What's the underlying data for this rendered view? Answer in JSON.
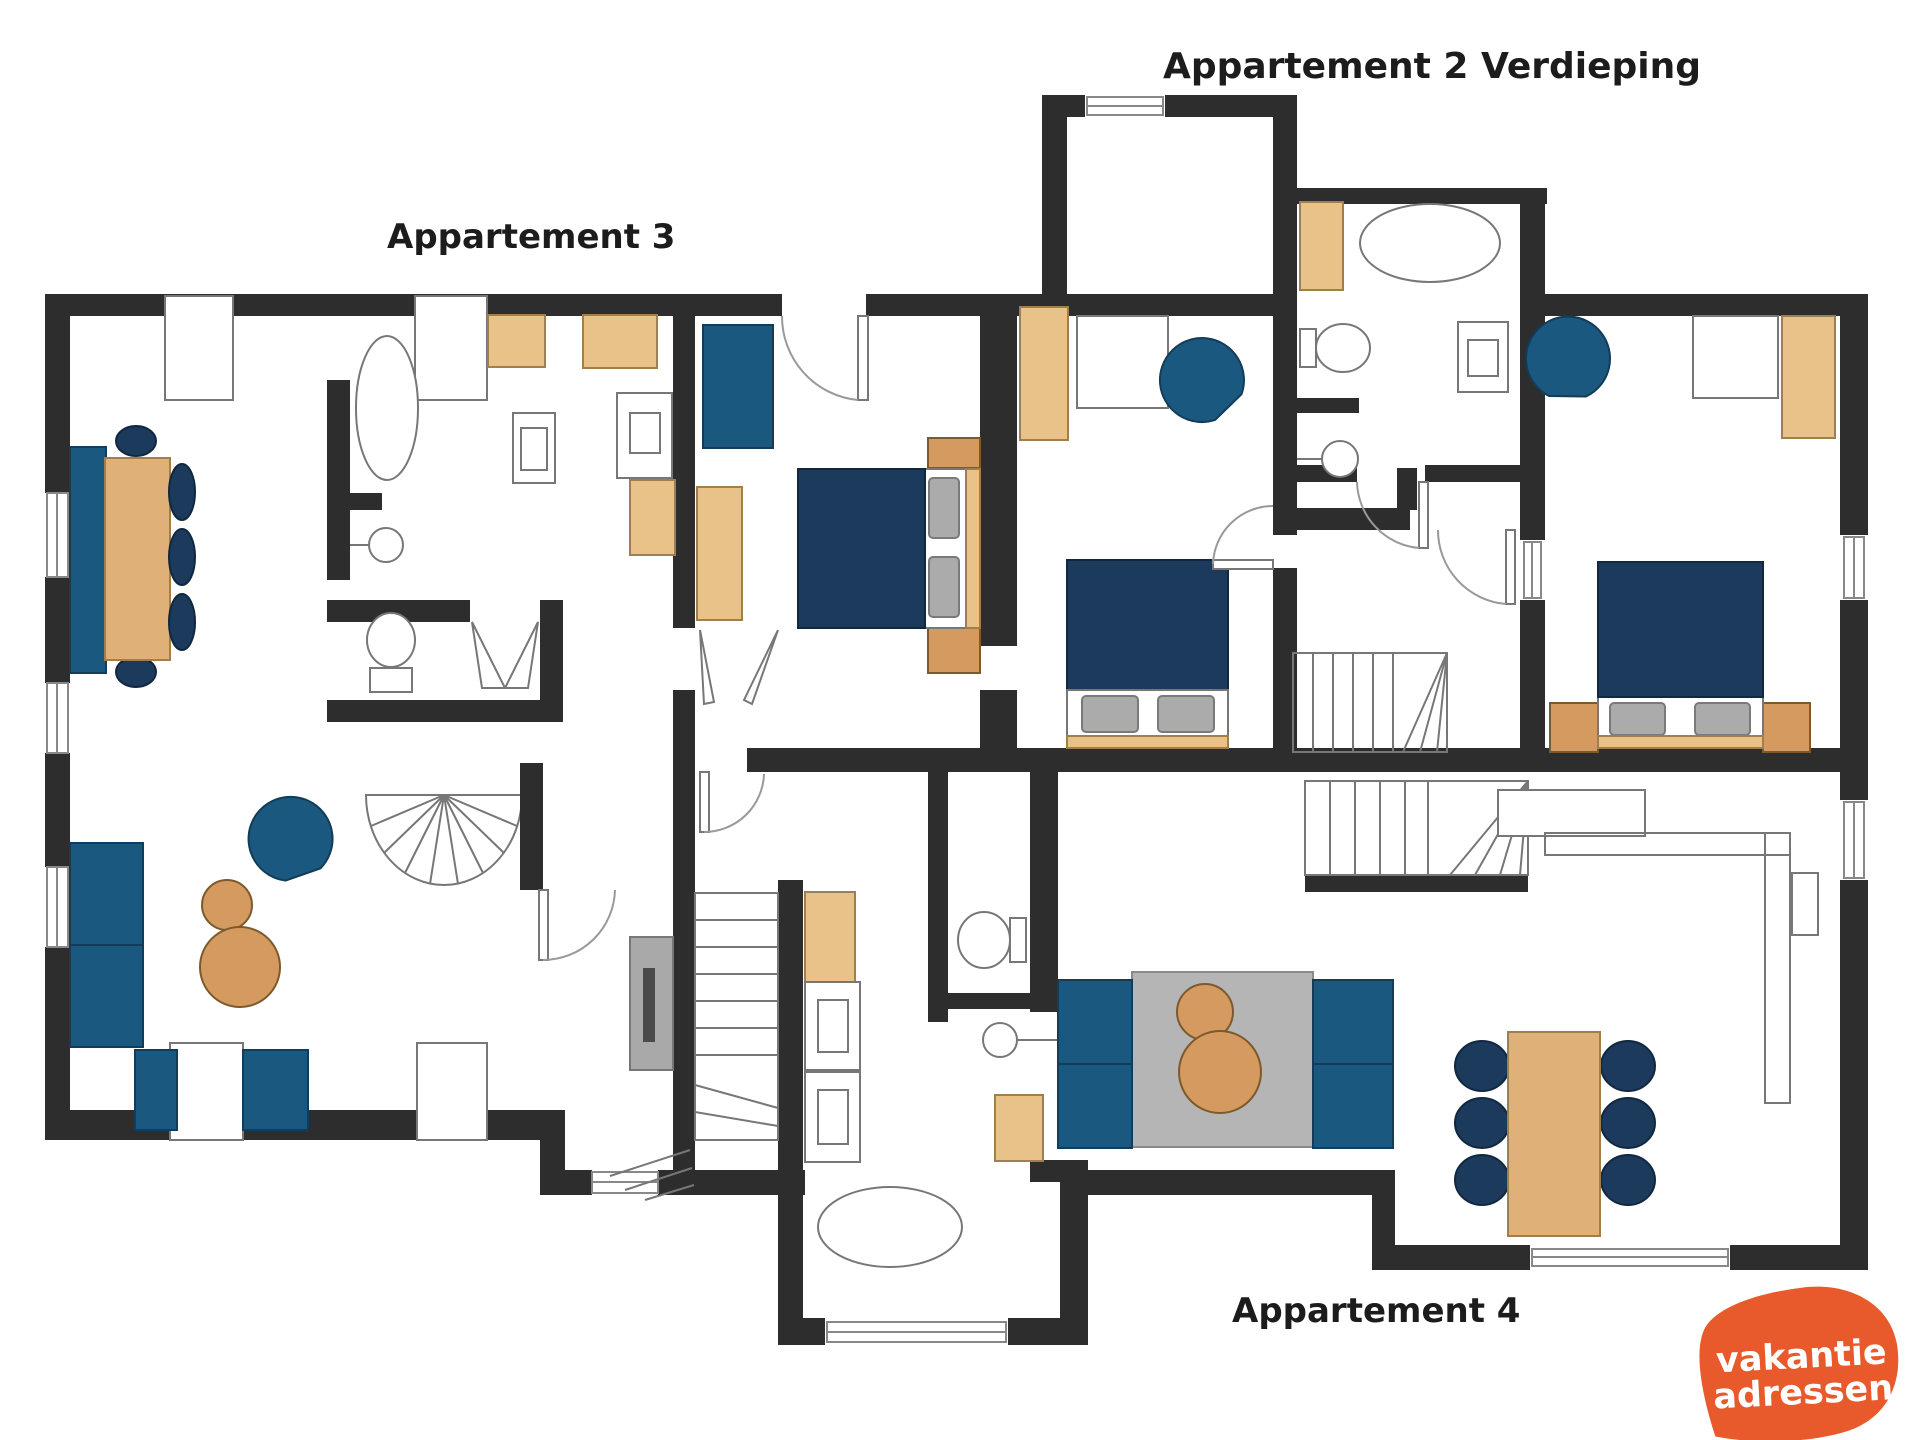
{
  "title_labels": {
    "apartment2": "Appartement 2 Verdieping",
    "apartment3": "Appartement 3",
    "apartment4": "Appartement 4"
  },
  "logo": {
    "line1": "vakantie",
    "line2": "adressen",
    "bg_color": "#e85a2b",
    "text_color": "#ffffff"
  },
  "palette": {
    "wall": "#2d2d2d",
    "bed_navy": "#1b3a5c",
    "seat_blue": "#1b5880",
    "wood_light": "#e9c28a",
    "wood_mid": "#dfb077",
    "wood_dark": "#d49a5f",
    "pillow_gray": "#ababab",
    "rug_gray": "#b5b5b5",
    "logo_orange": "#e85a2b"
  },
  "floorplan": {
    "type": "apartment floor plan, top-down",
    "apartments": [
      {
        "name": "Appartement 3",
        "rooms": [
          "living-dining room",
          "bathroom",
          "wc",
          "bedroom",
          "hall",
          "staircase"
        ],
        "furniture": [
          "dining table with bench and chairs",
          "sofa",
          "two armchairs",
          "lounge chair",
          "round side tables",
          "media unit",
          "double bed with nightstands",
          "bathtub",
          "sink",
          "toilet",
          "shower",
          "wardrobes",
          "spiral stair"
        ]
      },
      {
        "name": "Appartement 2 Verdieping",
        "rooms": [
          "bedroom left",
          "bedroom right",
          "bathroom",
          "hall",
          "staircase"
        ],
        "furniture": [
          "two double beds",
          "two lounge chairs",
          "desks",
          "wardrobes",
          "bathtub",
          "toilet",
          "sink",
          "shower"
        ]
      },
      {
        "name": "Appartement 4",
        "rooms": [
          "living room",
          "kitchen",
          "bathroom",
          "wc",
          "staircase"
        ],
        "furniture": [
          "two facing sofas with rug and round tables",
          "dining table with six chairs",
          "kitchen counter",
          "bathtub",
          "toilet",
          "sink",
          "cabinets"
        ]
      }
    ]
  }
}
